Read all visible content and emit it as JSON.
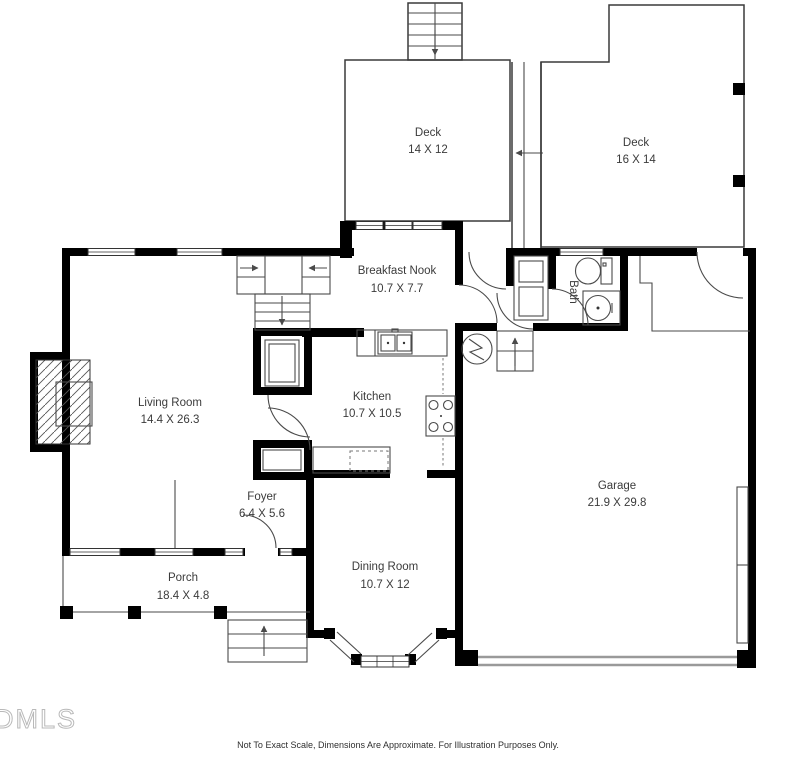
{
  "rooms": [
    {
      "id": "deck-top",
      "name": "Deck",
      "dims": "14 X 12"
    },
    {
      "id": "deck-right",
      "name": "Deck",
      "dims": "16 X 14"
    },
    {
      "id": "breakfast-nook",
      "name": "Breakfast Nook",
      "dims": "10.7 X 7.7"
    },
    {
      "id": "bath",
      "name": "Bath",
      "dims": ""
    },
    {
      "id": "living-room",
      "name": "Living Room",
      "dims": "14.4 X 26.3"
    },
    {
      "id": "kitchen",
      "name": "Kitchen",
      "dims": "10.7 X 10.5"
    },
    {
      "id": "garage",
      "name": "Garage",
      "dims": "21.9 X 29.8"
    },
    {
      "id": "foyer",
      "name": "Foyer",
      "dims": "6.4 X 5.6"
    },
    {
      "id": "porch",
      "name": "Porch",
      "dims": "18.4 X 4.8"
    },
    {
      "id": "dining-room",
      "name": "Dining Room",
      "dims": "10.7 X 12"
    }
  ],
  "footer": {
    "watermark": "DMLS",
    "disclaimer": "Not To Exact Scale, Dimensions Are Approximate. For Illustration Purposes Only."
  },
  "fixtures": [
    "fireplace",
    "interior-stairs",
    "deck-stairs",
    "porch-steps",
    "basement-steps",
    "furnace",
    "kitchen-sink",
    "stove",
    "dishwasher",
    "toilet",
    "bathroom-sink",
    "bay-window",
    "garage-door",
    "deck-walkway"
  ],
  "colors": {
    "wall": "#000000",
    "line": "#4a4a4a",
    "garage_door": "#9a9a9a",
    "label": "#3b3b3b",
    "watermark": "#b9b9b9",
    "background": "#ffffff"
  }
}
